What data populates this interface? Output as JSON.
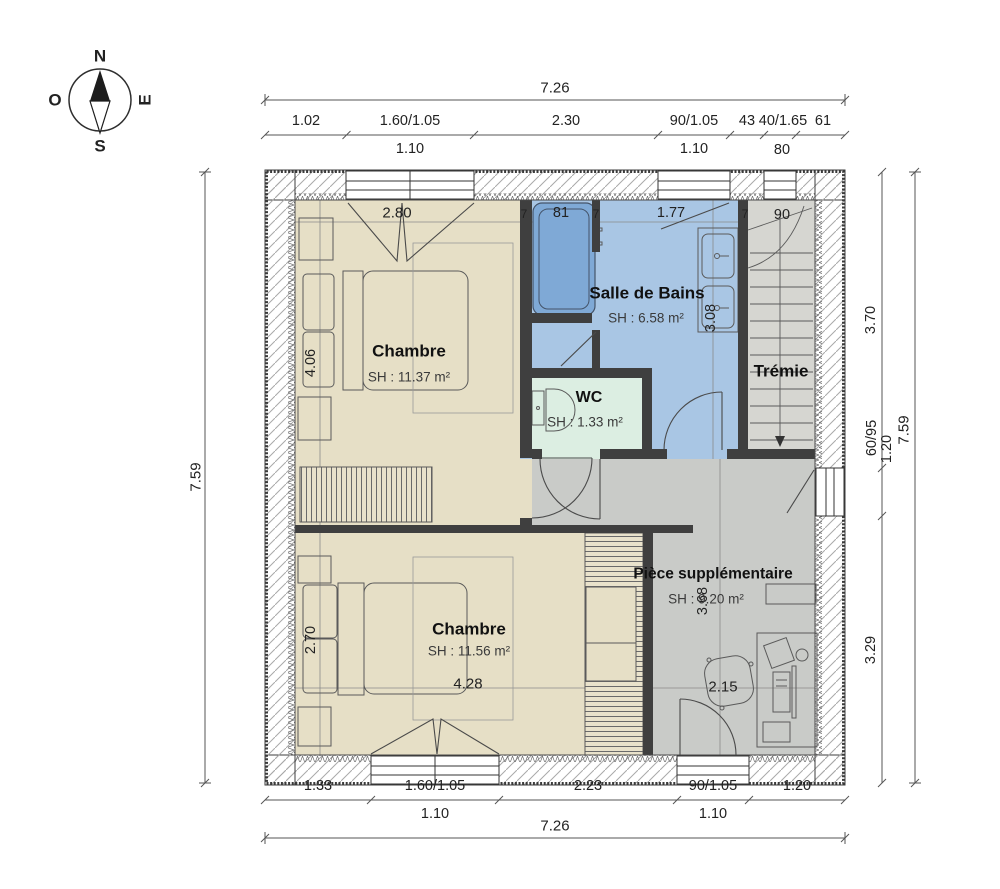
{
  "compass": {
    "north": "N",
    "south": "S",
    "east": "E",
    "west": "O"
  },
  "dims": {
    "top_total": "7.26",
    "top_1": "1.02",
    "top_2": "1.60/1.05",
    "top_2b": "1.10",
    "top_3": "2.30",
    "top_4": "90/1.05",
    "top_4b": "1.10",
    "top_5": "43",
    "top_6": "40/1.65",
    "top_6b": "80",
    "top_7": "61",
    "bottom_1": "1.33",
    "bottom_2": "1.60/1.05",
    "bottom_2b": "1.10",
    "bottom_3": "2.23",
    "bottom_4": "90/1.05",
    "bottom_4b": "1.10",
    "bottom_5": "1.20",
    "bottom_total": "7.26",
    "left_total": "7.59",
    "right_1": "3.70",
    "right_2": "60/95",
    "right_2b": "1.20",
    "right_3": "3.29",
    "right_total": "7.59"
  },
  "interior": {
    "chambre1_width": "2.80",
    "chambre1_height": "4.06",
    "wall_1": "7",
    "tub_width": "81",
    "wall_2": "7",
    "bath_width": "1.77",
    "wall_3": "7",
    "tremie_width": "90",
    "bath_height": "3.08",
    "chambre2_height": "2.70",
    "chambre2_width": "4.28",
    "suppl_height": "3.68",
    "suppl_width": "2.15"
  },
  "rooms": {
    "chambre1": {
      "name": "Chambre",
      "area": "SH : 11.37 m²"
    },
    "bath": {
      "name": "Salle de Bains",
      "area": "SH : 6.58 m²"
    },
    "wc": {
      "name": "WC",
      "area": "SH : 1.33 m²"
    },
    "tremie": {
      "name": "Trémie"
    },
    "chambre2": {
      "name": "Chambre",
      "area": "SH : 11.56 m²"
    },
    "suppl": {
      "name": "Pièce supplémentaire",
      "area": "SH : 9.20 m²"
    }
  },
  "colors": {
    "beige": "#e6dfc6",
    "blue": "#a9c6e4",
    "tub_blue": "#7fa9d6",
    "mint": "#dceee2",
    "gray": "#c9cbc8",
    "tremie_gray": "#d6d6d1",
    "wall_dark": "#3f3f3f",
    "hatch": "#a9a9a9",
    "line": "#555555"
  }
}
